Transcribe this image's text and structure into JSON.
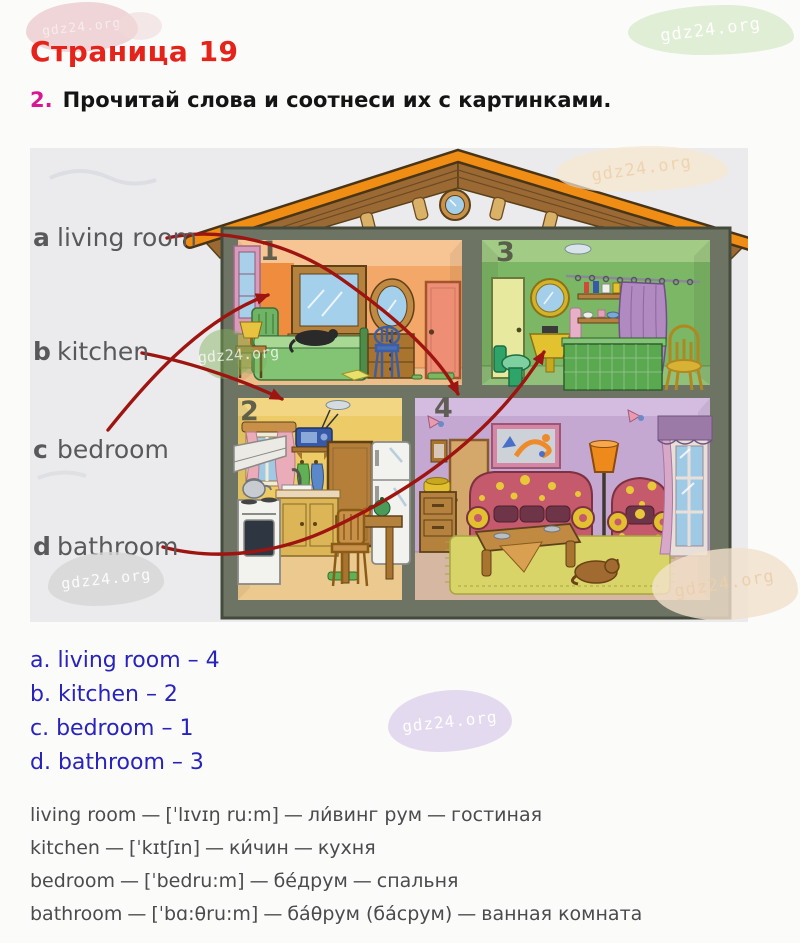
{
  "watermark_text": "gdz24.org",
  "page": {
    "title": "Страница 19"
  },
  "task": {
    "number": "2.",
    "text": "Прочитай слова и соотнеси их с картинками."
  },
  "word_list": [
    {
      "letter": "a",
      "word": "living room"
    },
    {
      "letter": "b",
      "word": "kitchen"
    },
    {
      "letter": "c",
      "word": "bedroom"
    },
    {
      "letter": "d",
      "word": "bathroom"
    }
  ],
  "house": {
    "rooms": [
      {
        "number": "1"
      },
      {
        "number": "2"
      },
      {
        "number": "3"
      },
      {
        "number": "4"
      }
    ]
  },
  "answers": [
    {
      "text": "a. living room – 4"
    },
    {
      "text": "b. kitchen – 2"
    },
    {
      "text": "c. bedroom – 1"
    },
    {
      "text": "d. bathroom – 3"
    }
  ],
  "separator": "—",
  "vocabulary": [
    {
      "word": "living room",
      "transcription": "[ˈlɪvɪŋ ru:m]",
      "pronunciation": "ли́винг рум",
      "translation": "гостиная"
    },
    {
      "word": "kitchen",
      "transcription": "[ˈkɪtʃɪn]",
      "pronunciation": "ки́чин",
      "translation": "кухня"
    },
    {
      "word": "bedroom",
      "transcription": "[ˈbedru:m]",
      "pronunciation": "бе́друм",
      "translation": "спальня"
    },
    {
      "word": "bathroom",
      "transcription": "[ˈbɑ:θru:m]",
      "pronunciation": "ба́θрум (ба́срум)",
      "translation": "ванная комната"
    }
  ],
  "colors": {
    "title_red": "#e5231b",
    "task_magenta": "#db1694",
    "word_gray": "#59595b",
    "answer_blue": "#2823bd",
    "vocab_gray": "#4b4b4d",
    "arrow_red": "#9e1410",
    "roof_orange": "#ef8d15",
    "room1_orange": "#f3a768",
    "room2_yellow": "#edcb66",
    "room3_green": "#7cb765",
    "room4_lavender": "#c4a8d2"
  }
}
